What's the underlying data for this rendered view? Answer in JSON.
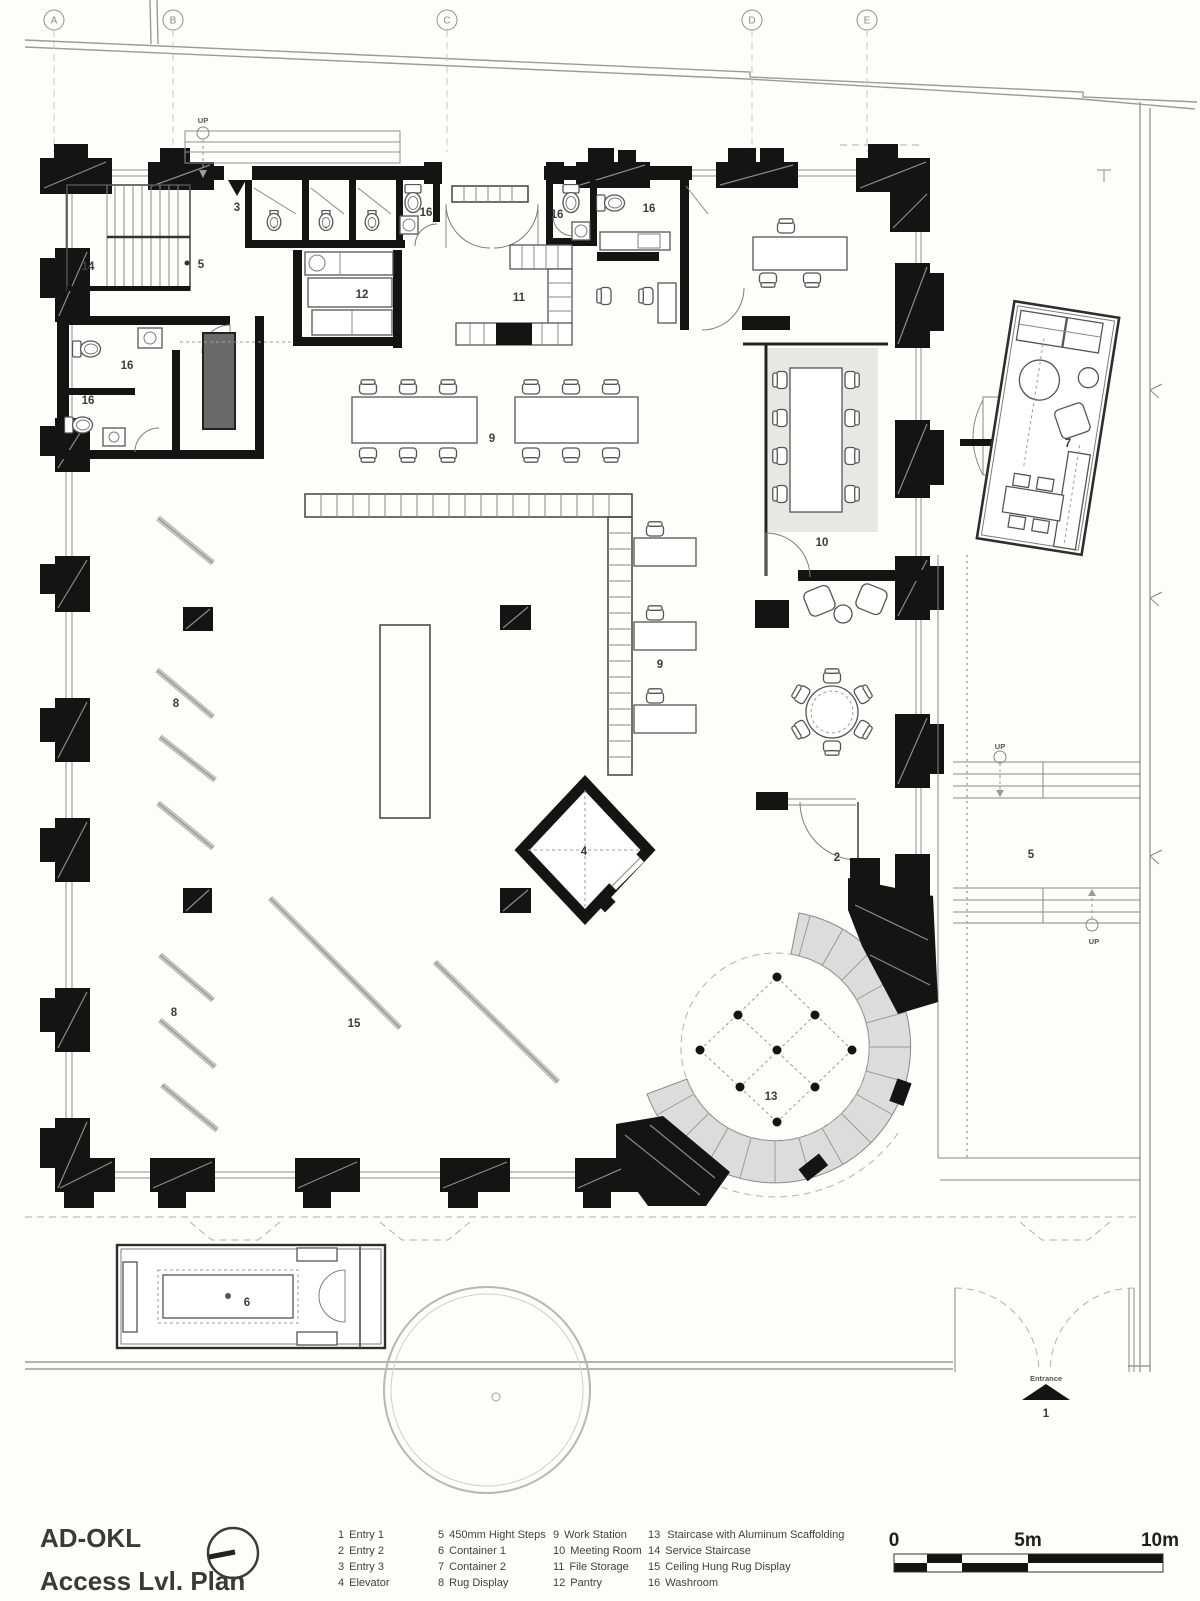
{
  "title_block": {
    "project": "AD-OKL",
    "plan_name": "Access Lvl. Plan"
  },
  "grid": {
    "labels": [
      "A",
      "B",
      "C",
      "D",
      "E"
    ]
  },
  "plan": {
    "labels": [
      {
        "t": "3"
      },
      {
        "t": "14"
      },
      {
        "t": "5"
      },
      {
        "t": "16"
      },
      {
        "t": "16"
      },
      {
        "t": "16"
      },
      {
        "t": "16"
      },
      {
        "t": "16"
      },
      {
        "t": "12"
      },
      {
        "t": "11"
      },
      {
        "t": "10"
      },
      {
        "t": "7"
      },
      {
        "t": "9"
      },
      {
        "t": "9"
      },
      {
        "t": "8"
      },
      {
        "t": "8"
      },
      {
        "t": "15"
      },
      {
        "t": "4"
      },
      {
        "t": "2"
      },
      {
        "t": "5"
      },
      {
        "t": "13"
      },
      {
        "t": "6"
      },
      {
        "t": "1"
      }
    ],
    "annotations": {
      "entrance": "Entrance",
      "up": "UP"
    }
  },
  "legend": {
    "columns": [
      {
        "items": [
          {
            "num": "1",
            "label": "Entry 1"
          },
          {
            "num": "2",
            "label": "Entry 2"
          },
          {
            "num": "3",
            "label": "Entry 3"
          },
          {
            "num": "4",
            "label": "Elevator"
          }
        ]
      },
      {
        "items": [
          {
            "num": "5",
            "label": "450mm Hight Steps"
          },
          {
            "num": "6",
            "label": "Container 1"
          },
          {
            "num": "7",
            "label": "Container 2"
          },
          {
            "num": "8",
            "label": "Rug Display"
          }
        ]
      },
      {
        "items": [
          {
            "num": "9",
            "label": "Work Station"
          },
          {
            "num": "10",
            "label": "Meeting Room"
          },
          {
            "num": "11",
            "label": "File Storage"
          },
          {
            "num": "12",
            "label": "Pantry"
          }
        ]
      },
      {
        "items": [
          {
            "num": "13",
            "label": "Staircase with Aluminum Scaffolding"
          },
          {
            "num": "14",
            "label": "Service Staircase"
          },
          {
            "num": "15",
            "label": "Ceiling Hung Rug Display"
          },
          {
            "num": "16",
            "label": "Washroom"
          }
        ]
      }
    ]
  },
  "scale_bar": {
    "start": "0",
    "mid": "5m",
    "end": "10m"
  },
  "colors": {
    "wall": "#141414",
    "line": "#555555",
    "light": "#9a9a9a",
    "room_fill": "#e7e7e5",
    "tread_fill": "#dedede"
  }
}
